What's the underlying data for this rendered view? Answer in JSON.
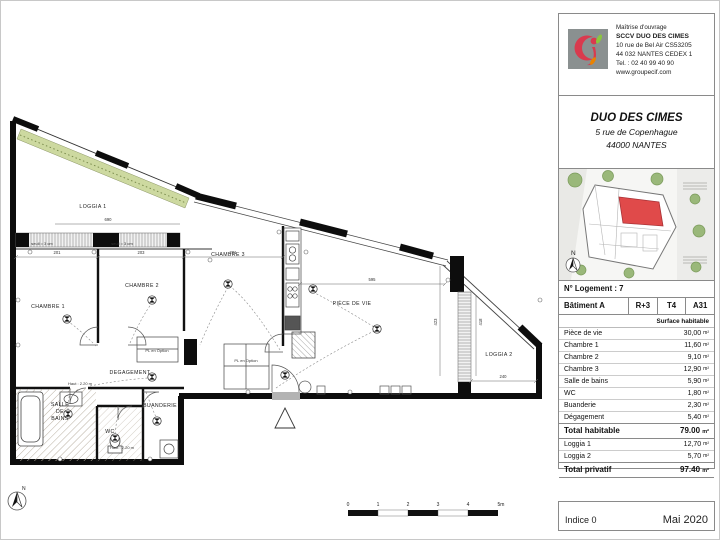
{
  "panel": {
    "owner": {
      "label": "Maîtrise d'ouvrage",
      "name": "SCCV DUO DES CIMES",
      "address1": "10 rue de Bel Air CS53205",
      "address2": "44 032 NANTES CEDEX 1",
      "phone": "Tel. : 02 40 99 40 90",
      "website": "www.groupecif.com"
    },
    "project": {
      "name": "DUO DES CIMES",
      "address1": "5 rue de Copenhague",
      "address2": "44000 NANTES"
    },
    "unit": {
      "logement": "N° Logement : 7",
      "batiment": "Bâtiment A",
      "etage": "R+3",
      "type": "T4",
      "ref": "A31",
      "surface_header": "Surface habitable"
    },
    "areas": {
      "rows": [
        {
          "label": "Pièce de vie",
          "value": "30,00",
          "unit": "m²"
        },
        {
          "label": "Chambre 1",
          "value": "11,60",
          "unit": "m²"
        },
        {
          "label": "Chambre 2",
          "value": "9,10",
          "unit": "m²"
        },
        {
          "label": "Chambre 3",
          "value": "12,90",
          "unit": "m²"
        },
        {
          "label": "Salle de bains",
          "value": "5,90",
          "unit": "m²"
        },
        {
          "label": "WC",
          "value": "1,80",
          "unit": "m²"
        },
        {
          "label": "Buanderie",
          "value": "2,30",
          "unit": "m²"
        },
        {
          "label": "Dégagement",
          "value": "5,40",
          "unit": "m²"
        }
      ],
      "total_habitable": {
        "label": "Total habitable",
        "value": "79.00",
        "unit": "m²"
      },
      "loggia_rows": [
        {
          "label": "Loggia 1",
          "value": "12,70",
          "unit": "m²"
        },
        {
          "label": "Loggia 2",
          "value": "5,70",
          "unit": "m²"
        }
      ],
      "total_privatif": {
        "label": "Total privatif",
        "value": "97.40",
        "unit": "m²"
      }
    },
    "footer": {
      "indice": "Indice 0",
      "date": "Mai 2020"
    },
    "site": {
      "north_label": "N"
    },
    "colors": {
      "unit_highlight": "#e04a4a",
      "logo_red": "#d93a4e",
      "logo_green": "#8bc53f",
      "logo_orange": "#e98300",
      "logo_gray": "#8a9090",
      "planting_green": "#cdd9a0"
    }
  },
  "plan": {
    "north_label": "N",
    "rooms": [
      {
        "label": "LOGGIA 1"
      },
      {
        "label": "CHAMBRE 1"
      },
      {
        "label": "CHAMBRE 2"
      },
      {
        "label": "CHAMBRE 3"
      },
      {
        "label": "PIÈCE DE VIE"
      },
      {
        "label": "DEGAGEMENT"
      },
      {
        "lines": [
          "SALLE",
          "DE",
          "BAINS"
        ]
      },
      {
        "label": "WC"
      },
      {
        "label": "BUANDERIE"
      },
      {
        "label": "LOGGIA 2"
      }
    ],
    "annotations": [
      {
        "text": "PL en Option"
      },
      {
        "text": "PL en Option"
      },
      {
        "text": "Haut : 2.20 m"
      },
      {
        "text": "Haut : 2.20 m"
      },
      {
        "text": "seuil = 3 cm"
      },
      {
        "text": "seuil = 3 cm"
      },
      {
        "text": "690"
      },
      {
        "text": "201"
      },
      {
        "text": "203"
      },
      {
        "text": "201"
      },
      {
        "text": "595"
      },
      {
        "text": "240"
      },
      {
        "text": "423"
      },
      {
        "text": "418"
      }
    ],
    "scalebar": {
      "labels": [
        "0",
        "1",
        "2",
        "3",
        "4",
        "5m"
      ]
    }
  }
}
